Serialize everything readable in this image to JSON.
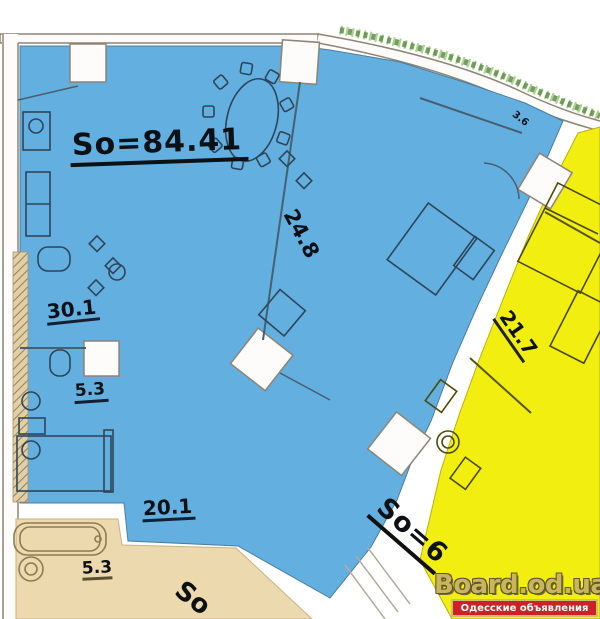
{
  "plan_title": "apartment-floor-plan",
  "colors": {
    "unit_blue_fill": "#63afe0",
    "unit_yellow_fill": "#f2ee10",
    "unit_tan_fill": "#ecd9ae",
    "wall_edge": "#8f8476",
    "facade_hatch_green": "#5a9140",
    "watermark_gold": "#c8b164",
    "banner_red": "#cb2127"
  },
  "units": {
    "blue": {
      "total": "So=84.41",
      "rooms": [
        "30.1",
        "24.8",
        "5.3",
        "20.1",
        "3.6"
      ]
    },
    "yellow": {
      "total": "So=6",
      "rooms": [
        "21.7"
      ]
    },
    "tan": {
      "total": "So",
      "rooms": [
        "5.3"
      ]
    }
  },
  "watermark": {
    "site": "Board.od.ua",
    "tagline": "Одесские объявления"
  }
}
